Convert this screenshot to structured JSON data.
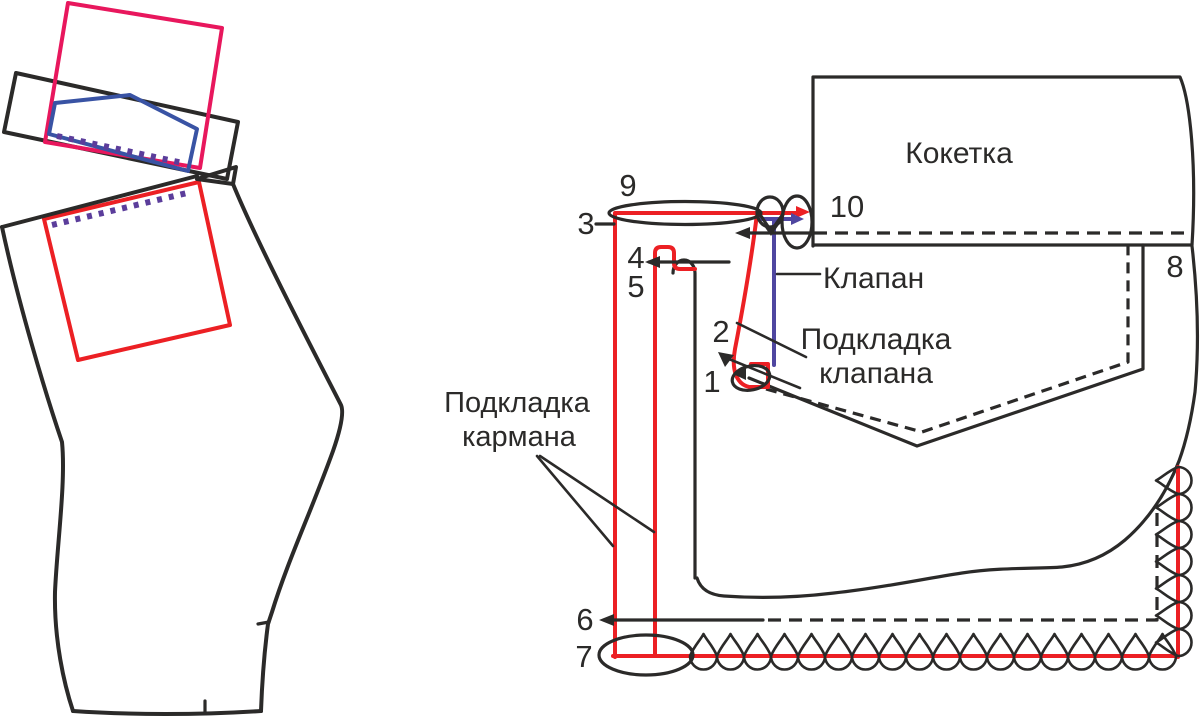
{
  "figure": {
    "description": "Sewing instruction diagram for a trouser yoke pocket with flap",
    "labels": {
      "yoke": "Кокетка",
      "flap": "Клапан",
      "flap_lining_line1": "Подкладка",
      "flap_lining_line2": "клапана",
      "pocket_lining_line1": "Подкладка",
      "pocket_lining_line2": "кармана"
    },
    "markers": {
      "m1": "1",
      "m2": "2",
      "m3": "3",
      "m4": "4",
      "m5": "5",
      "m6": "6",
      "m7": "7",
      "m8": "8",
      "m9": "9",
      "m10": "10"
    }
  },
  "colors": {
    "background": "#ffffff",
    "black": "#2b2a29",
    "red": "#ec2024",
    "crimson": "#e8175d",
    "blue": "#3953a4",
    "indigo": "#4f46a0",
    "purple": "#5b3d9b"
  }
}
